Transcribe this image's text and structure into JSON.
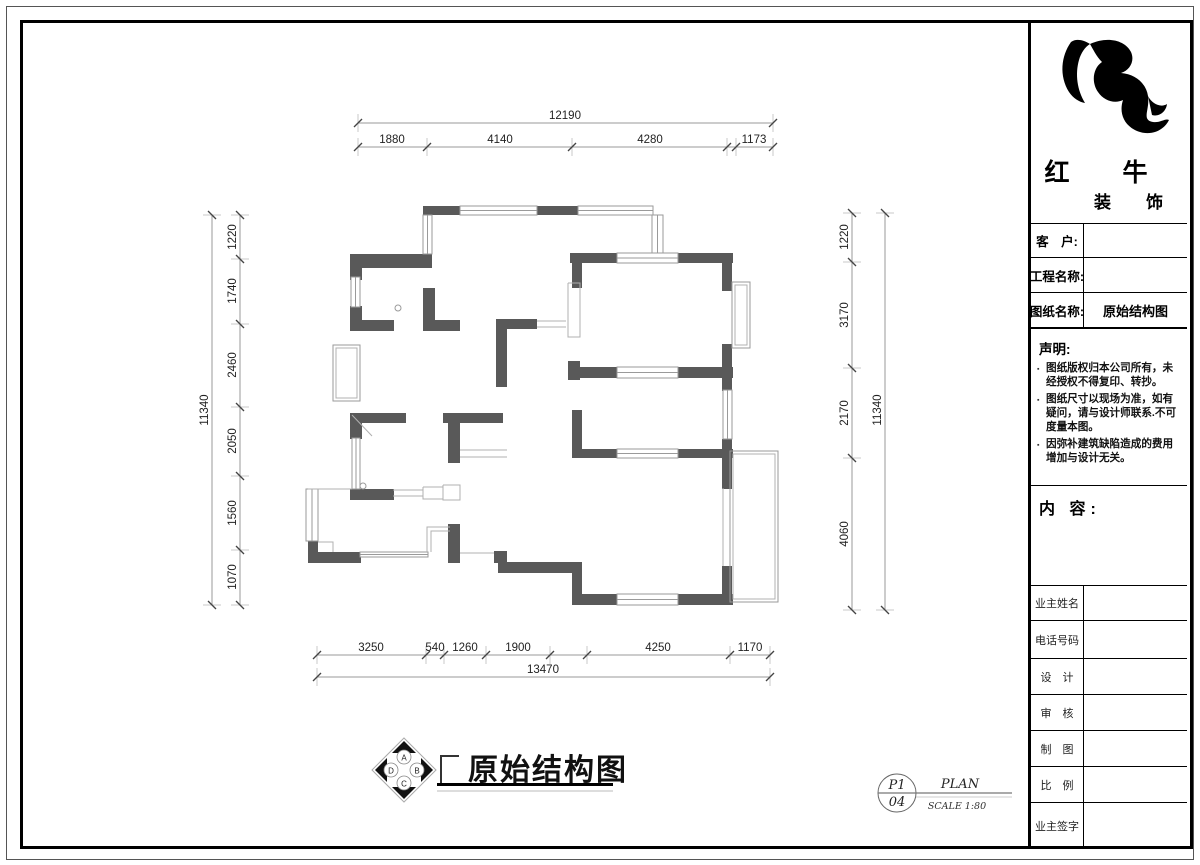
{
  "colors": {
    "wall": "#595959",
    "window_line": "#9a9a9a",
    "thin_line": "#b0b0b0",
    "dim_line": "#999999",
    "dim_ext": "#c9c9c9",
    "dim_tick": "#444444",
    "dim_text": "#222222",
    "frame": "#000000"
  },
  "title_block": {
    "logo": {
      "name_top": "红　牛",
      "name_bottom": "装　饰",
      "mark": "bull-swoosh"
    },
    "fields": [
      {
        "label": "客　户:",
        "value": ""
      },
      {
        "label": "工程名称:",
        "value": ""
      },
      {
        "label": "图纸名称:",
        "value": "原始结构图"
      }
    ],
    "statement": {
      "heading": "声明:",
      "bullet_char": "▪",
      "items": [
        "图纸版权归本公司所有，未经授权不得复印、转抄。",
        "图纸尺寸以现场为准，如有疑问，请与设计师联系.不可度量本图。",
        "因弥补建筑缺陷造成的费用增加与设计无关。"
      ]
    },
    "content_heading": "内 容:",
    "rows": [
      {
        "label": "业主姓名",
        "value": ""
      },
      {
        "label": "电话号码",
        "value": ""
      },
      {
        "label": "设　计",
        "value": ""
      },
      {
        "label": "审　核",
        "value": ""
      },
      {
        "label": "制　图",
        "value": ""
      },
      {
        "label": "比　例",
        "value": ""
      },
      {
        "label": "业主签字",
        "value": ""
      }
    ]
  },
  "footer": {
    "drawing_title": "原始结构图",
    "compass_letters": [
      "A",
      "B",
      "C",
      "D"
    ],
    "sheet_no_top": "P1",
    "sheet_no_bottom": "04",
    "plan_label": "PLAN",
    "scale_label": "SCALE 1:80"
  },
  "plan": {
    "walls": [
      [
        423,
        206,
        37,
        9
      ],
      [
        537,
        206,
        42,
        9
      ],
      [
        350,
        254,
        82,
        14
      ],
      [
        350,
        268,
        12,
        12
      ],
      [
        350,
        306,
        12,
        25
      ],
      [
        350,
        320,
        44,
        11
      ],
      [
        423,
        288,
        12,
        43
      ],
      [
        423,
        320,
        37,
        11
      ],
      [
        570,
        253,
        47,
        10
      ],
      [
        678,
        253,
        55,
        10
      ],
      [
        572,
        253,
        10,
        35
      ],
      [
        722,
        253,
        10,
        38
      ],
      [
        722,
        344,
        10,
        46
      ],
      [
        496,
        319,
        41,
        10
      ],
      [
        496,
        319,
        11,
        68
      ],
      [
        568,
        361,
        12,
        19
      ],
      [
        572,
        367,
        45,
        11
      ],
      [
        678,
        367,
        55,
        11
      ],
      [
        722,
        367,
        10,
        24
      ],
      [
        350,
        413,
        56,
        10
      ],
      [
        443,
        413,
        60,
        10
      ],
      [
        448,
        413,
        12,
        50
      ],
      [
        350,
        413,
        12,
        26
      ],
      [
        350,
        489,
        44,
        11
      ],
      [
        308,
        541,
        10,
        22
      ],
      [
        308,
        552,
        53,
        11
      ],
      [
        448,
        524,
        12,
        39
      ],
      [
        494,
        551,
        13,
        12
      ],
      [
        498,
        562,
        82,
        11
      ],
      [
        572,
        562,
        10,
        43
      ],
      [
        572,
        594,
        46,
        11
      ],
      [
        678,
        594,
        55,
        11
      ],
      [
        722,
        566,
        10,
        39
      ],
      [
        572,
        410,
        10,
        48
      ],
      [
        572,
        449,
        46,
        9
      ],
      [
        678,
        449,
        55,
        9
      ],
      [
        722,
        439,
        10,
        50
      ]
    ],
    "windows": [
      [
        460,
        206,
        77,
        9,
        "h"
      ],
      [
        578,
        206,
        75,
        9,
        "h"
      ],
      [
        652,
        215,
        11,
        38,
        "v"
      ],
      [
        423,
        215,
        9,
        39,
        "v"
      ],
      [
        351,
        277,
        9,
        30,
        "v"
      ],
      [
        617,
        253,
        61,
        10,
        "h"
      ],
      [
        617,
        367,
        61,
        11,
        "h"
      ],
      [
        352,
        438,
        8,
        51,
        "v"
      ],
      [
        306,
        489,
        12,
        52,
        "v"
      ],
      [
        360,
        552,
        68,
        5,
        "h"
      ],
      [
        617,
        449,
        61,
        9,
        "h"
      ],
      [
        723,
        390,
        9,
        49,
        "v"
      ],
      [
        617,
        594,
        61,
        11,
        "h"
      ],
      [
        732,
        282,
        18,
        66,
        "f"
      ],
      [
        730,
        451,
        48,
        151,
        "f"
      ],
      [
        333,
        345,
        27,
        56,
        "f"
      ]
    ],
    "lines": [
      [
        [
          393,
          490
        ],
        [
          423,
          490
        ]
      ],
      [
        [
          393,
          496
        ],
        [
          423,
          496
        ]
      ],
      [
        [
          423,
          487
        ],
        [
          443,
          487
        ],
        [
          443,
          499
        ],
        [
          423,
          499
        ],
        [
          423,
          487
        ]
      ],
      [
        [
          443,
          485
        ],
        [
          460,
          485
        ],
        [
          460,
          500
        ],
        [
          443,
          500
        ],
        [
          443,
          485
        ]
      ],
      [
        [
          537,
          321
        ],
        [
          566,
          321
        ]
      ],
      [
        [
          537,
          327
        ],
        [
          566,
          327
        ]
      ],
      [
        [
          568,
          283
        ],
        [
          580,
          283
        ],
        [
          580,
          337
        ],
        [
          568,
          337
        ],
        [
          568,
          283
        ]
      ],
      [
        [
          460,
          450
        ],
        [
          507,
          450
        ]
      ],
      [
        [
          460,
          457
        ],
        [
          507,
          457
        ]
      ],
      [
        [
          427,
          552
        ],
        [
          427,
          527
        ],
        [
          450,
          527
        ]
      ],
      [
        [
          431,
          552
        ],
        [
          431,
          531
        ],
        [
          450,
          531
        ]
      ],
      [
        [
          352,
          415
        ],
        [
          372,
          436
        ]
      ],
      [
        [
          460,
          553
        ],
        [
          494,
          553
        ]
      ],
      [
        [
          723,
          488
        ],
        [
          723,
          566
        ]
      ],
      [
        [
          308,
          489
        ],
        [
          352,
          489
        ]
      ],
      [
        [
          318,
          542
        ],
        [
          333,
          542
        ],
        [
          333,
          552
        ]
      ]
    ],
    "circles": [
      [
        398,
        308
      ],
      [
        363,
        486
      ]
    ]
  },
  "dimensions": [
    {
      "dir": "h",
      "line": 123,
      "from": 358,
      "to": 773,
      "ticks": [
        358,
        773
      ],
      "labels": [
        {
          "t": "12190",
          "p": 565
        }
      ]
    },
    {
      "dir": "h",
      "line": 147,
      "from": 358,
      "to": 773,
      "ticks": [
        358,
        427,
        572,
        727,
        736,
        773
      ],
      "labels": [
        {
          "t": "1880",
          "p": 392
        },
        {
          "t": "4140",
          "p": 500
        },
        {
          "t": "4280",
          "p": 650
        },
        {
          "t": "1173",
          "p": 754
        }
      ]
    },
    {
      "dir": "v",
      "line": 212,
      "from": 215,
      "to": 605,
      "ticks": [
        215,
        605
      ],
      "labels": [
        {
          "t": "11340",
          "p": 410
        }
      ]
    },
    {
      "dir": "v",
      "line": 240,
      "from": 215,
      "to": 605,
      "ticks": [
        215,
        259,
        324,
        407,
        476,
        550,
        605
      ],
      "labels": [
        {
          "t": "1220",
          "p": 237
        },
        {
          "t": "1740",
          "p": 291
        },
        {
          "t": "2460",
          "p": 365
        },
        {
          "t": "2050",
          "p": 441
        },
        {
          "t": "1560",
          "p": 513
        },
        {
          "t": "1070",
          "p": 577
        }
      ]
    },
    {
      "dir": "v",
      "line": 852,
      "from": 213,
      "to": 610,
      "ticks": [
        213,
        262,
        368,
        458,
        610
      ],
      "labels": [
        {
          "t": "1220",
          "p": 237
        },
        {
          "t": "3170",
          "p": 315
        },
        {
          "t": "2170",
          "p": 413
        },
        {
          "t": "4060",
          "p": 534
        }
      ]
    },
    {
      "dir": "v",
      "line": 885,
      "from": 213,
      "to": 610,
      "ticks": [
        213,
        610
      ],
      "labels": [
        {
          "t": "11340",
          "p": 410
        }
      ]
    },
    {
      "dir": "h",
      "line": 655,
      "from": 317,
      "to": 770,
      "ticks": [
        317,
        426,
        444,
        486,
        550,
        587,
        730,
        770
      ],
      "labels": [
        {
          "t": "3250",
          "p": 371
        },
        {
          "t": "540",
          "p": 435
        },
        {
          "t": "1260",
          "p": 465
        },
        {
          "t": "1900",
          "p": 518
        },
        {
          "t": "4250",
          "p": 658
        },
        {
          "t": "1170",
          "p": 750
        }
      ]
    },
    {
      "dir": "h",
      "line": 677,
      "from": 317,
      "to": 770,
      "ticks": [
        317,
        770
      ],
      "labels": [
        {
          "t": "13470",
          "p": 543
        }
      ]
    }
  ]
}
